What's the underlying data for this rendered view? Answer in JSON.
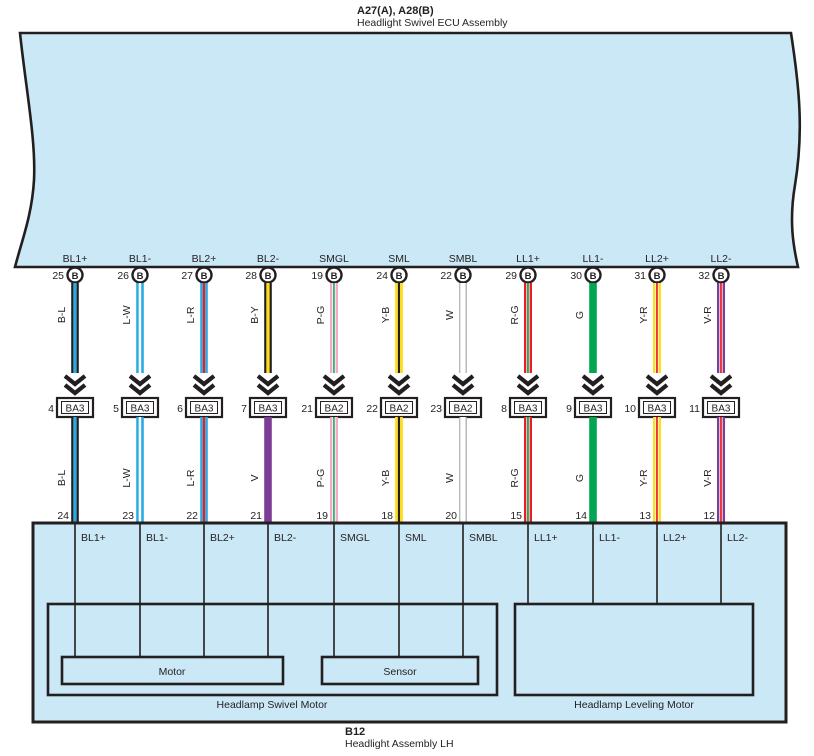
{
  "header": {
    "code": "A27(A), A28(B)",
    "name": "Headlight Swivel ECU Assembly"
  },
  "footer": {
    "code": "B12",
    "name": "Headlight Assembly LH"
  },
  "pin_circle_letter": "B",
  "components": {
    "motor": "Motor",
    "sensor": "Sensor",
    "swivel_motor": "Headlamp Swivel Motor",
    "leveling_motor": "Headlamp Leveling Motor"
  },
  "colors": {
    "panel_fill": "#cbe8f6",
    "outline": "#231f20",
    "cyan": "#29abe2",
    "red": "#ed1c24",
    "green": "#00a651",
    "yellow": "#ffde17",
    "pink": "#f8a8c8",
    "purple": "#7c3d97",
    "white": "#ffffff",
    "gray": "#a7a9ac"
  },
  "wires": [
    {
      "signal": "BL1+",
      "ecu_pin": "25",
      "code_upper": "B-L",
      "inline_pin": "4",
      "inline_connector": "BA3",
      "code_lower": "B-L",
      "assembly_pin": "24",
      "assembly_cell": "BL1+",
      "stripes_upper": [
        [
          "#231f20",
          2.2
        ],
        [
          "#29abe2",
          3.2
        ],
        [
          "#231f20",
          2.2
        ]
      ],
      "stripes_lower": [
        [
          "#231f20",
          2.2
        ],
        [
          "#29abe2",
          3.2
        ],
        [
          "#231f20",
          2.2
        ]
      ]
    },
    {
      "signal": "BL1-",
      "ecu_pin": "26",
      "code_upper": "L-W",
      "inline_pin": "5",
      "inline_connector": "BA3",
      "code_lower": "L-W",
      "assembly_pin": "23",
      "assembly_cell": "BL1-",
      "stripes_upper": [
        [
          "#29abe2",
          2.6
        ],
        [
          "#ffffff",
          2.4
        ],
        [
          "#29abe2",
          2.6
        ]
      ],
      "stripes_lower": [
        [
          "#29abe2",
          2.6
        ],
        [
          "#ffffff",
          2.4
        ],
        [
          "#29abe2",
          2.6
        ]
      ]
    },
    {
      "signal": "BL2+",
      "ecu_pin": "27",
      "code_upper": "L-R",
      "inline_pin": "6",
      "inline_connector": "BA3",
      "code_lower": "L-R",
      "assembly_pin": "22",
      "assembly_cell": "BL2+",
      "stripes_upper": [
        [
          "#29abe2",
          2.6
        ],
        [
          "#ed1c24",
          2.4
        ],
        [
          "#29abe2",
          2.6
        ]
      ],
      "stripes_lower": [
        [
          "#29abe2",
          2.6
        ],
        [
          "#ed1c24",
          2.4
        ],
        [
          "#29abe2",
          2.6
        ]
      ]
    },
    {
      "signal": "BL2-",
      "ecu_pin": "28",
      "code_upper": "B-Y",
      "inline_pin": "7",
      "inline_connector": "BA3",
      "code_lower": "V",
      "assembly_pin": "21",
      "assembly_cell": "BL2-",
      "stripes_upper": [
        [
          "#231f20",
          2.2
        ],
        [
          "#ffde17",
          3.2
        ],
        [
          "#231f20",
          2.2
        ]
      ],
      "stripes_lower": [
        [
          "#7c3d97",
          7.6
        ]
      ]
    },
    {
      "signal": "SMGL",
      "ecu_pin": "19",
      "code_upper": "P-G",
      "inline_pin": "21",
      "inline_connector": "BA2",
      "code_lower": "P-G",
      "assembly_pin": "19",
      "assembly_cell": "SMGL",
      "stripes_upper": [
        [
          "#f8a8c8",
          2.4
        ],
        [
          "#ffffff",
          0.8
        ],
        [
          "#00a651",
          1.6
        ],
        [
          "#ffffff",
          0.8
        ],
        [
          "#f8a8c8",
          2.4
        ]
      ],
      "stripes_lower": [
        [
          "#f8a8c8",
          2.4
        ],
        [
          "#ffffff",
          0.8
        ],
        [
          "#00a651",
          1.6
        ],
        [
          "#ffffff",
          0.8
        ],
        [
          "#f8a8c8",
          2.4
        ]
      ]
    },
    {
      "signal": "SML",
      "ecu_pin": "24",
      "code_upper": "Y-B",
      "inline_pin": "22",
      "inline_connector": "BA2",
      "code_lower": "Y-B",
      "assembly_pin": "18",
      "assembly_cell": "SML",
      "stripes_upper": [
        [
          "#ffde17",
          2.8
        ],
        [
          "#231f20",
          2.2
        ],
        [
          "#ffde17",
          2.8
        ]
      ],
      "stripes_lower": [
        [
          "#ffde17",
          2.8
        ],
        [
          "#231f20",
          2.2
        ],
        [
          "#ffde17",
          2.8
        ]
      ]
    },
    {
      "signal": "SMBL",
      "ecu_pin": "22",
      "code_upper": "W",
      "inline_pin": "23",
      "inline_connector": "BA2",
      "code_lower": "W",
      "assembly_pin": "20",
      "assembly_cell": "SMBL",
      "stripes_upper": [
        [
          "#a7a9ac",
          1.2
        ],
        [
          "#ffffff",
          5.2
        ],
        [
          "#a7a9ac",
          1.2
        ]
      ],
      "stripes_lower": [
        [
          "#a7a9ac",
          1.2
        ],
        [
          "#ffffff",
          5.2
        ],
        [
          "#a7a9ac",
          1.2
        ]
      ]
    },
    {
      "signal": "LL1+",
      "ecu_pin": "29",
      "code_upper": "R-G",
      "inline_pin": "8",
      "inline_connector": "BA3",
      "code_lower": "R-G",
      "assembly_pin": "15",
      "assembly_cell": "LL1+",
      "stripes_upper": [
        [
          "#ed1c24",
          2.4
        ],
        [
          "#ffffff",
          0.7
        ],
        [
          "#00a651",
          1.8
        ],
        [
          "#ffffff",
          0.7
        ],
        [
          "#ed1c24",
          2.4
        ]
      ],
      "stripes_lower": [
        [
          "#ed1c24",
          2.4
        ],
        [
          "#ffffff",
          0.7
        ],
        [
          "#00a651",
          1.8
        ],
        [
          "#ffffff",
          0.7
        ],
        [
          "#ed1c24",
          2.4
        ]
      ]
    },
    {
      "signal": "LL1-",
      "ecu_pin": "30",
      "code_upper": "G",
      "inline_pin": "9",
      "inline_connector": "BA3",
      "code_lower": "G",
      "assembly_pin": "14",
      "assembly_cell": "LL1-",
      "stripes_upper": [
        [
          "#00a651",
          7.6
        ]
      ],
      "stripes_lower": [
        [
          "#00a651",
          7.6
        ]
      ]
    },
    {
      "signal": "LL2+",
      "ecu_pin": "31",
      "code_upper": "Y-R",
      "inline_pin": "10",
      "inline_connector": "BA3",
      "code_lower": "Y-R",
      "assembly_pin": "13",
      "assembly_cell": "LL2+",
      "stripes_upper": [
        [
          "#ffde17",
          2.4
        ],
        [
          "#ffffff",
          0.7
        ],
        [
          "#ed1c24",
          1.8
        ],
        [
          "#ffffff",
          0.7
        ],
        [
          "#ffde17",
          2.4
        ]
      ],
      "stripes_lower": [
        [
          "#ffde17",
          2.4
        ],
        [
          "#ffffff",
          0.7
        ],
        [
          "#ed1c24",
          1.8
        ],
        [
          "#ffffff",
          0.7
        ],
        [
          "#ffde17",
          2.4
        ]
      ]
    },
    {
      "signal": "LL2-",
      "ecu_pin": "32",
      "code_upper": "V-R",
      "inline_pin": "11",
      "inline_connector": "BA3",
      "code_lower": "V-R",
      "assembly_pin": "12",
      "assembly_cell": "LL2-",
      "stripes_upper": [
        [
          "#7c3d97",
          2.4
        ],
        [
          "#ffffff",
          0.7
        ],
        [
          "#ed1c24",
          1.8
        ],
        [
          "#ffffff",
          0.7
        ],
        [
          "#7c3d97",
          2.4
        ]
      ],
      "stripes_lower": [
        [
          "#7c3d97",
          2.4
        ],
        [
          "#ffffff",
          0.7
        ],
        [
          "#ed1c24",
          1.8
        ],
        [
          "#ffffff",
          0.7
        ],
        [
          "#7c3d97",
          2.4
        ]
      ]
    }
  ]
}
